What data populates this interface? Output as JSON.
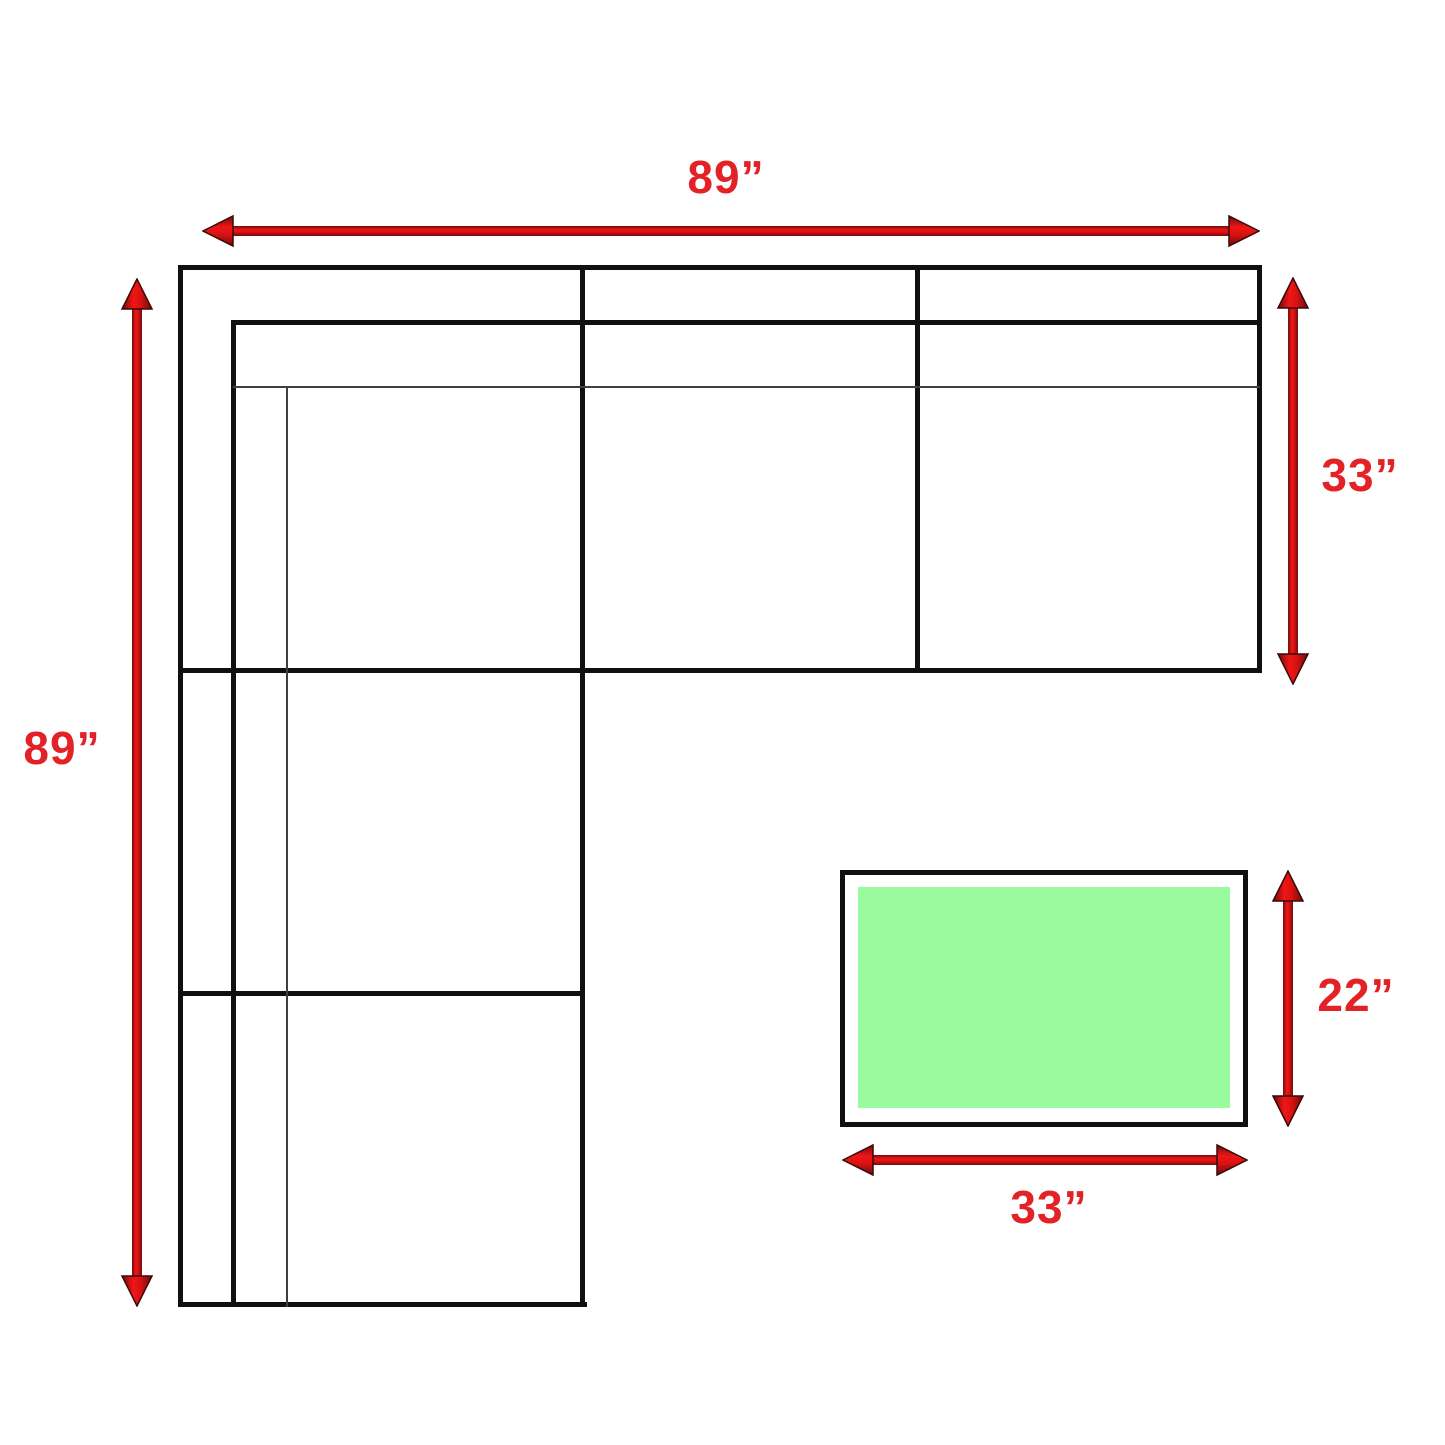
{
  "diagram": {
    "kind": "sectional-sofa-floor-plan-with-ottoman"
  },
  "dimensions": {
    "sofa_width": "89”",
    "sofa_depth": "89”",
    "chaise_depth": "33”",
    "ottoman_depth": "22”",
    "ottoman_width": "33”"
  },
  "colors": {
    "arrow_red": "#e01414",
    "arrow_edge_dark_red": "#6f0d0d",
    "label_red": "#e32227",
    "outline_black": "#101010",
    "thin_line_gray": "#3f3f3f",
    "ottoman_fill_green": "#9afb9e",
    "background": "#ffffff"
  }
}
